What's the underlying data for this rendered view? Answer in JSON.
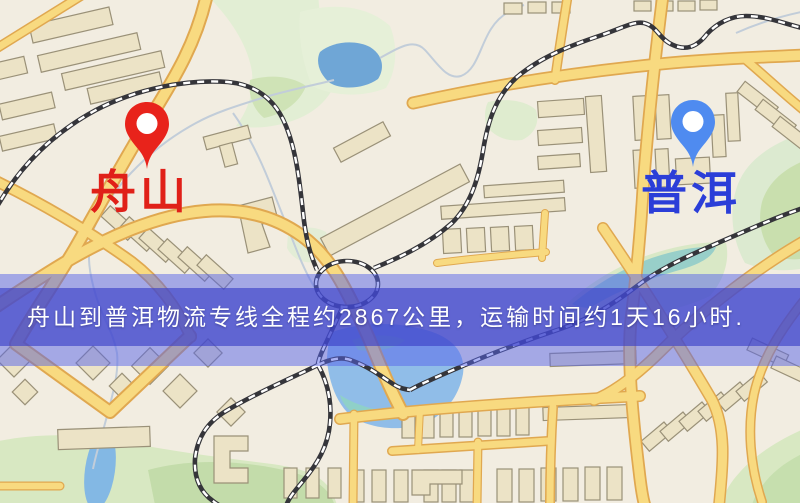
{
  "markers": {
    "origin": {
      "label": "舟山",
      "pin_icon": "red-map-pin",
      "pin_color": "#e8231b",
      "label_color": "#e02018"
    },
    "destination": {
      "label": "普洱",
      "pin_icon": "blue-map-pin",
      "pin_color": "#4f8bf0",
      "label_color": "#2b3ed8"
    }
  },
  "banner": {
    "text": "舟山到普洱物流专线全程约2867公里，运输时间约1天16小时.",
    "origin": "舟山",
    "destination": "普洱",
    "distance": "约2867公里",
    "duration": "约1天16小时",
    "text_color": "#ffffff"
  },
  "map_colors": {
    "background": "#f2ede1",
    "road_fill": "#f8da80",
    "road_casing": "#e0a850",
    "water": "#74a9d9",
    "park": "#dcead0",
    "railway": "#35353a",
    "building_fill": "#ece3c6",
    "building_outline": "#9a9178"
  }
}
